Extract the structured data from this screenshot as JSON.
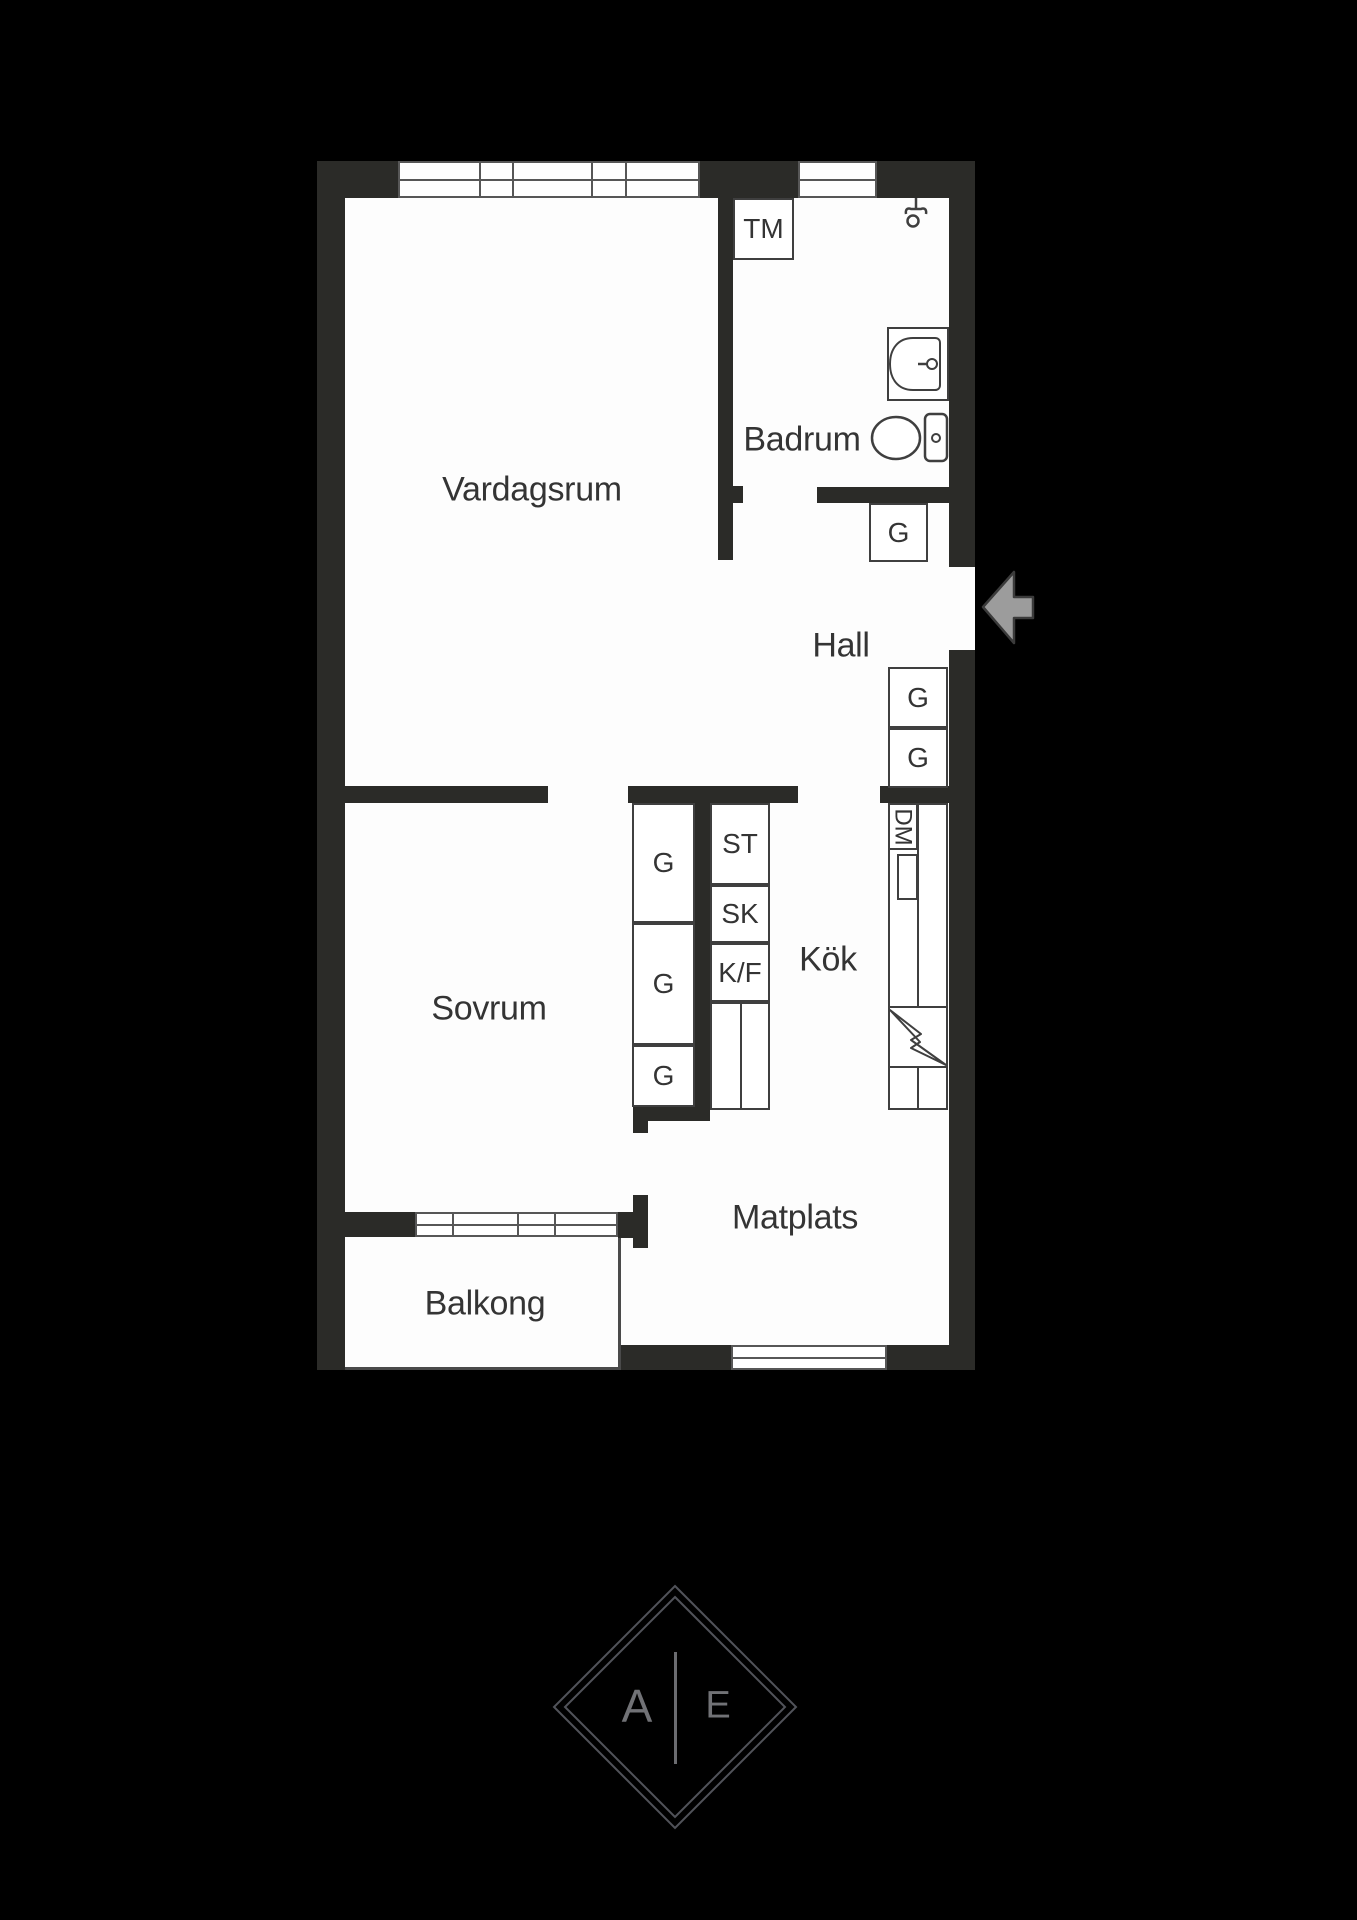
{
  "floorplan": {
    "rooms": {
      "vardagsrum": "Vardagsrum",
      "badrum": "Badrum",
      "hall": "Hall",
      "sovrum": "Sovrum",
      "kok": "Kök",
      "matplats": "Matplats",
      "balkong": "Balkong"
    },
    "fixtures": {
      "tm": "TM",
      "dm": "DM",
      "st": "ST",
      "sk": "SK",
      "kf": "K/F",
      "g": "G"
    },
    "colors": {
      "background": "#000000",
      "wall": "#2b2b28",
      "floor": "#fdfdfd",
      "box_line": "#3f3f3f",
      "window_line": "#575757",
      "text": "#343434",
      "entry_arrow": "#9c9c9c",
      "logo_line": "#51535a",
      "logo_text": "#717276"
    }
  },
  "logo": {
    "left": "A",
    "right": "E"
  }
}
